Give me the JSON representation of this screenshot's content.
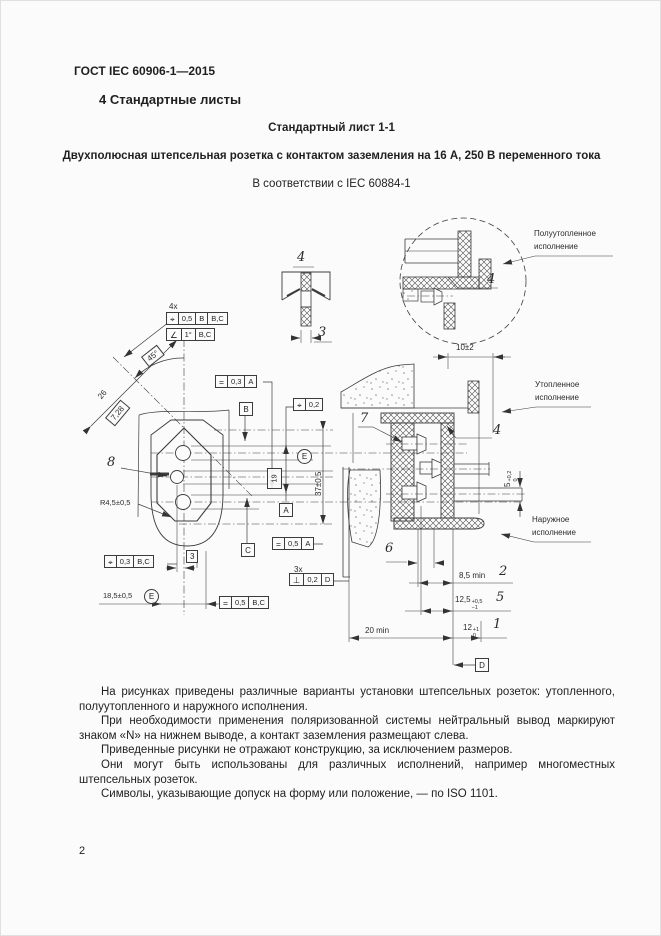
{
  "page": {
    "doc_code": "ГОСТ IEC 60906-1—2015",
    "section_heading": "4  Стандартные листы",
    "sheet_heading": "Стандартный лист 1-1",
    "sheet_description": "Двухполюсная штепсельная розетка с контактом заземления на 16 А, 250 В переменного тока",
    "conformance": "В соответствии с IEC 60884-1",
    "page_number": "2"
  },
  "drawing": {
    "variant_labels": {
      "semi_flush_line1": "Полуутопленное",
      "semi_flush_line2": "исполнение",
      "flush_line1": "Утопленное",
      "flush_line2": "исполнение",
      "surface_line1": "Наружное",
      "surface_line2": "исполнение"
    },
    "items": {
      "i1": "1",
      "i2": "2",
      "i3": "3",
      "i4": "4",
      "i5": "5",
      "i6": "6",
      "i7": "7",
      "i8": "8"
    },
    "dimensions": {
      "count_4x": "4x",
      "count_3x": "3x",
      "angle_45": "45°",
      "dim_26": "26",
      "dim_7_28": "7,28",
      "dim_19": "19",
      "dim_37": "37±0,5",
      "dim_r45": "R4,5±0,5",
      "dim_18_5": "18,5±0,5",
      "dim_3": "3",
      "dim_10": "10±2",
      "dim_5_base": "5",
      "dim_5_sup": "+0,2",
      "dim_5_sub": "0",
      "dim_8_5": "8,5 min",
      "dim_12_5_base": "12,5",
      "dim_12_5_sup": "+0,5",
      "dim_12_5_sub": "−1",
      "dim_20": "20 min",
      "dim_12_base": "12",
      "dim_12_sup": "+1",
      "dim_12_sub": "0"
    },
    "gdt": {
      "frames": {
        "f1": {
          "sym": "⌖",
          "tol": "0,5",
          "d1": "B",
          "d2": "B,C"
        },
        "f2": {
          "sym": "∠",
          "tol": "1°",
          "d1": "B,C"
        },
        "f3": {
          "sym": "=",
          "tol": "0,3",
          "d1": "A"
        },
        "f4": {
          "sym": "⌖",
          "tol": "0,2"
        },
        "f5": {
          "sym": "=",
          "tol": "0,5",
          "d1": "A"
        },
        "f6": {
          "sym": "⊥",
          "tol": "0,2",
          "d1": "D"
        },
        "f7": {
          "sym": "⌖",
          "tol": "0,3",
          "d1": "B,C"
        },
        "f8": {
          "sym": "=",
          "tol": "0,5",
          "d1": "B,C"
        }
      },
      "datums": {
        "A": "A",
        "B": "B",
        "C": "C",
        "D": "D"
      },
      "envelope": "E"
    }
  },
  "notes": {
    "paragraphs": [
      "На рисунках приведены различные варианты установки штепсельных розеток: утопленного, полуутопленного и наружного исполнения.",
      "При необходимости применения поляризованной системы нейтральный вывод маркируют знаком «N» на нижнем выводе, а контакт заземления размещают слева.",
      "Приведенные рисунки не отражают конструкцию, за исключением размеров.",
      "Они могут быть использованы для различных исполнений, например многоместных штепсельных розеток.",
      "Символы, указывающие допуск на форму или положение, — по ISO 1101."
    ]
  }
}
